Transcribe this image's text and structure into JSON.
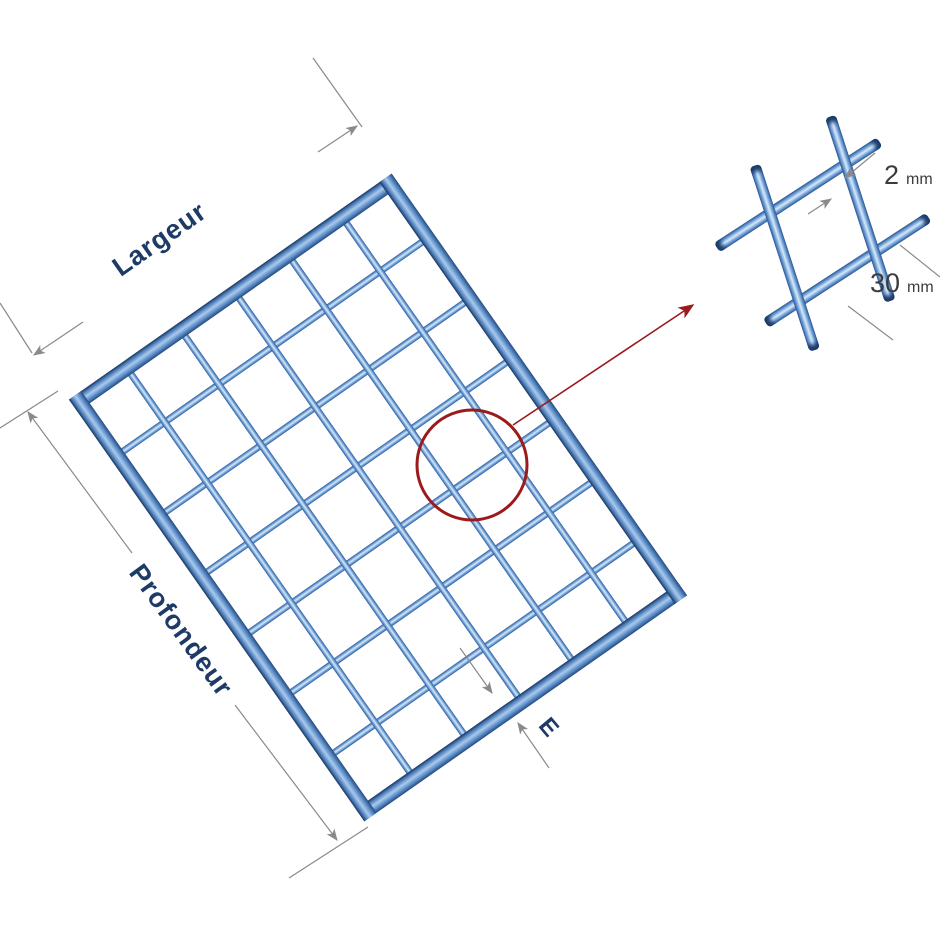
{
  "figure": {
    "type": "technical-diagram",
    "subject": "welded wire mesh panel with dimension callout",
    "labels": {
      "width_label": "Largeur",
      "depth_label": "Profondeur",
      "edge_label": "E"
    },
    "detail_callout": {
      "wire_diameter_value": "2",
      "wire_diameter_unit": "mm",
      "mesh_opening_value": "30",
      "mesh_opening_unit": "mm"
    },
    "mesh": {
      "columns": 6,
      "rows": 7
    },
    "colors": {
      "wire_dark": "#2d5a9b",
      "wire_highlight": "#d9e9f9",
      "frame_dark": "#16335c",
      "label_navy": "#1e3a66",
      "dimension_gray": "#8a8a8a",
      "annotation_red": "#9b1b1b",
      "detail_text": "#3c3c3c"
    }
  }
}
